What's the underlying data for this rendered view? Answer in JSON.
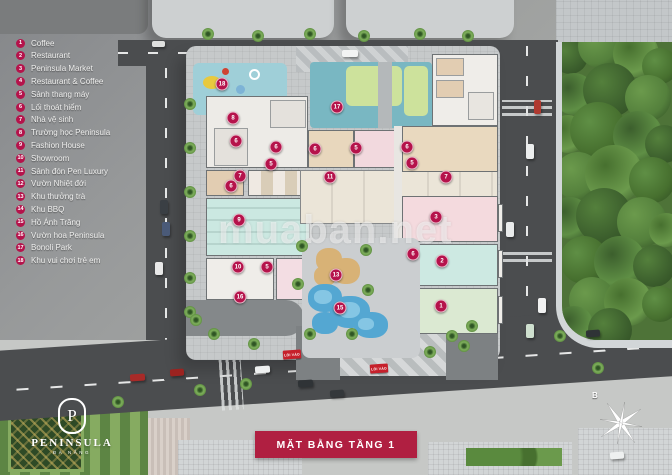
{
  "legend": {
    "items": [
      {
        "num": "1",
        "label": "Coffee"
      },
      {
        "num": "2",
        "label": "Restaurant"
      },
      {
        "num": "3",
        "label": "Peninsula Market"
      },
      {
        "num": "4",
        "label": "Restaurant & Coffee"
      },
      {
        "num": "5",
        "label": "Sảnh thang máy"
      },
      {
        "num": "6",
        "label": "Lối thoát hiểm"
      },
      {
        "num": "7",
        "label": "Nhà vệ sinh"
      },
      {
        "num": "8",
        "label": "Trường học Peninsula"
      },
      {
        "num": "9",
        "label": "Fashion House"
      },
      {
        "num": "10",
        "label": "Showroom"
      },
      {
        "num": "11",
        "label": "Sảnh đón Pen Luxury"
      },
      {
        "num": "12",
        "label": "Vườn Nhiệt đới"
      },
      {
        "num": "13",
        "label": "Khu thưởng trà"
      },
      {
        "num": "14",
        "label": "Khu BBQ"
      },
      {
        "num": "15",
        "label": "Hồ Ánh Trăng"
      },
      {
        "num": "16",
        "label": "Vườn hoa Peninsula"
      },
      {
        "num": "17",
        "label": "Bonoli Park"
      },
      {
        "num": "18",
        "label": "Khu vui chơi trẻ em"
      }
    ]
  },
  "banner": {
    "title": "MẶT BẰNG TẦNG 1"
  },
  "logo": {
    "initial": "P",
    "name": "PENINSULA",
    "subtitle": "ĐÀ NẴNG"
  },
  "compass": {
    "north_label": "B"
  },
  "watermark": {
    "text": "muaban.net"
  },
  "map": {
    "entrance_label": "LỐI VÀO",
    "markers": [
      {
        "num": "18",
        "x": 222,
        "y": 84
      },
      {
        "num": "8",
        "x": 233,
        "y": 118
      },
      {
        "num": "6",
        "x": 236,
        "y": 141
      },
      {
        "num": "6",
        "x": 276,
        "y": 147
      },
      {
        "num": "5",
        "x": 271,
        "y": 164
      },
      {
        "num": "7",
        "x": 240,
        "y": 176
      },
      {
        "num": "6",
        "x": 231,
        "y": 186
      },
      {
        "num": "9",
        "x": 239,
        "y": 220
      },
      {
        "num": "10",
        "x": 238,
        "y": 267
      },
      {
        "num": "5",
        "x": 267,
        "y": 267
      },
      {
        "num": "16",
        "x": 240,
        "y": 297
      },
      {
        "num": "17",
        "x": 337,
        "y": 107
      },
      {
        "num": "6",
        "x": 315,
        "y": 149
      },
      {
        "num": "5",
        "x": 356,
        "y": 148
      },
      {
        "num": "6",
        "x": 407,
        "y": 147
      },
      {
        "num": "5",
        "x": 412,
        "y": 163
      },
      {
        "num": "7",
        "x": 446,
        "y": 177
      },
      {
        "num": "11",
        "x": 330,
        "y": 177
      },
      {
        "num": "3",
        "x": 436,
        "y": 217
      },
      {
        "num": "6",
        "x": 413,
        "y": 254
      },
      {
        "num": "2",
        "x": 442,
        "y": 261
      },
      {
        "num": "1",
        "x": 441,
        "y": 306
      },
      {
        "num": "13",
        "x": 336,
        "y": 275
      },
      {
        "num": "15",
        "x": 340,
        "y": 308
      }
    ]
  },
  "colors": {
    "marker": "#b5134b",
    "banner": "#b01f41",
    "road": "#4b4d4f",
    "park_green": "#4e7338",
    "pool_blue": "#54a7d2"
  }
}
